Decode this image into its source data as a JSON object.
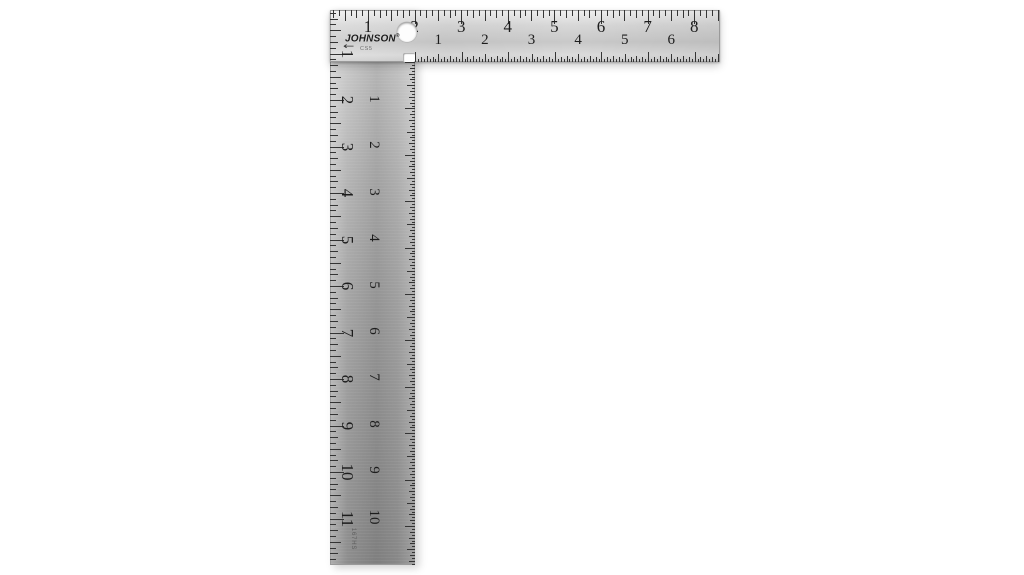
{
  "window": {
    "background": "#ffffff"
  },
  "product": {
    "brand": "JOHNSON",
    "brand_mark": "®",
    "model_label": "CS5",
    "part_number": "167HS"
  },
  "square": {
    "type": "L-shaped steel carpenter square, photographed on white",
    "metal_color": "#b7b7b7",
    "tick_color": "#343434",
    "number_color": "#1d1d1d",
    "hole": "hanging-hole near top corner",
    "scales": {
      "blade_top": {
        "label": "horizontal blade, outer (top) edge",
        "unit": "inch",
        "divisions_per_inch": 8,
        "numbers": [
          1,
          2,
          3,
          4,
          5,
          6,
          7,
          8
        ]
      },
      "blade_inner": {
        "label": "horizontal blade, inner (bottom) edge",
        "unit": "inch",
        "divisions_per_inch": 16,
        "numbers": [
          1,
          2,
          3,
          4,
          5,
          6
        ]
      },
      "tongue_outer": {
        "label": "vertical tongue, outer (left) edge",
        "unit": "inch",
        "divisions_per_inch": 8,
        "numbers": [
          1,
          2,
          3,
          4,
          5,
          6,
          7,
          8,
          9,
          10,
          11
        ]
      },
      "tongue_inner": {
        "label": "vertical tongue, inner (right) edge",
        "unit": "inch",
        "divisions_per_inch": 16,
        "numbers": [
          1,
          2,
          3,
          4,
          5,
          6,
          7,
          8,
          9,
          10
        ]
      }
    }
  }
}
